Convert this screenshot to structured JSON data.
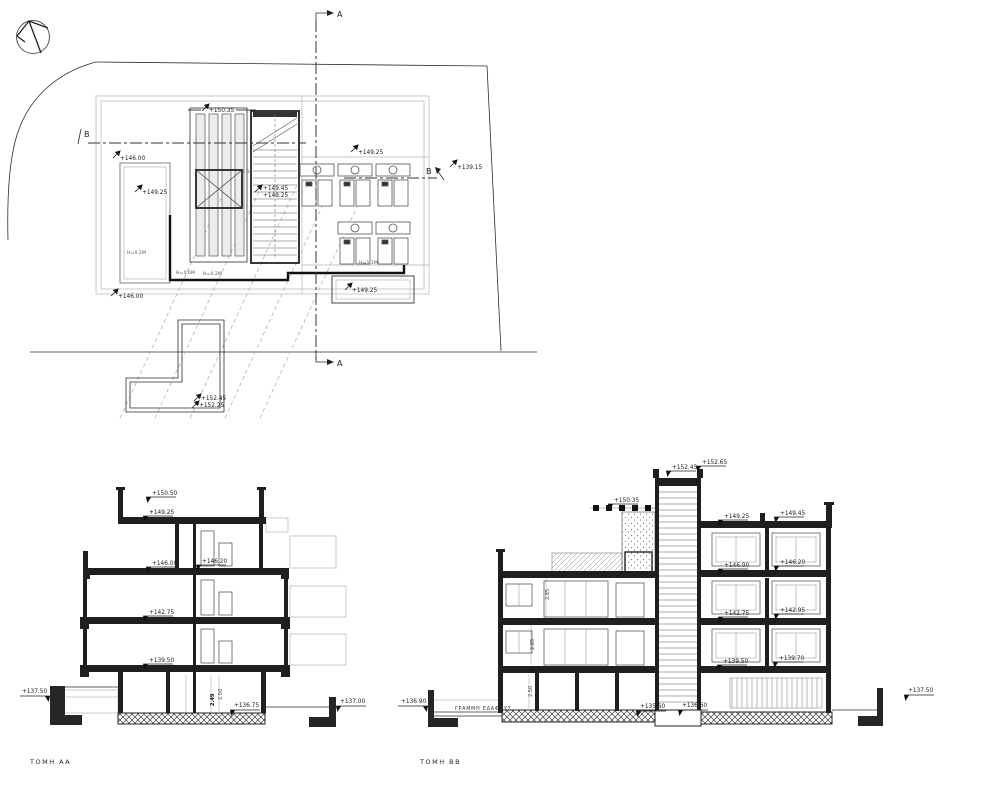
{
  "plan": {
    "section_a": "A",
    "section_b": "B",
    "levels": {
      "roof_slats": "+150.35",
      "terrace_left_upper": "+146.00",
      "room_left": "+149.25",
      "stair_top_a": "+149.45",
      "stair_top_b": "+149.25",
      "roof_right": "+149.25",
      "ground_right": "+139.15",
      "terrace_left_lower": "+146.00",
      "balcony_roof": "+149.25",
      "stair_bulkhead_a": "+152.45",
      "stair_bulkhead_b": "+152.25"
    },
    "heights": {
      "h1": "H=0.2M",
      "h2": "H=0.6M",
      "h3": "H=0.2M",
      "h4": "H=1.1M"
    },
    "dims": {
      "stair_width": "1.50"
    }
  },
  "section_aa": {
    "title": "ΤΟΜΗ ΑΑ",
    "levels": {
      "parapet": "+150.50",
      "roof": "+149.25",
      "floor3": "+146.00",
      "floor3b": "+146.20",
      "floor2": "+142.75",
      "floor1": "+139.50",
      "ground_left": "+137.50",
      "basement": "+136.75",
      "ground_right": "+137.00"
    },
    "dims": {
      "h1": "2.50",
      "h2": "2.49"
    }
  },
  "section_bb": {
    "title": "ΤΟΜΗ ΒΒ",
    "levels": {
      "bulkhead_a": "+152.45",
      "bulkhead_b": "+152.65",
      "pergola": "+150.35",
      "roof_a": "+149.25",
      "roof_b": "+149.45",
      "floor3a": "+146.00",
      "floor3b": "+146.20",
      "floor2a": "+142.75",
      "floor2b": "+142.95",
      "floor1a": "+139.50",
      "floor1b": "+139.70",
      "ground_left": "+136.90",
      "basement_a": "+135.60",
      "basement_b": "+136.60",
      "ground_right": "+137.50"
    },
    "dims": {
      "h1": "2.85",
      "h2": "2.85",
      "h3": "2.50"
    },
    "notes": {
      "ground_line": "ΓΡΑΜΜΗ ΕΔΑΦΟΥΣ"
    }
  }
}
